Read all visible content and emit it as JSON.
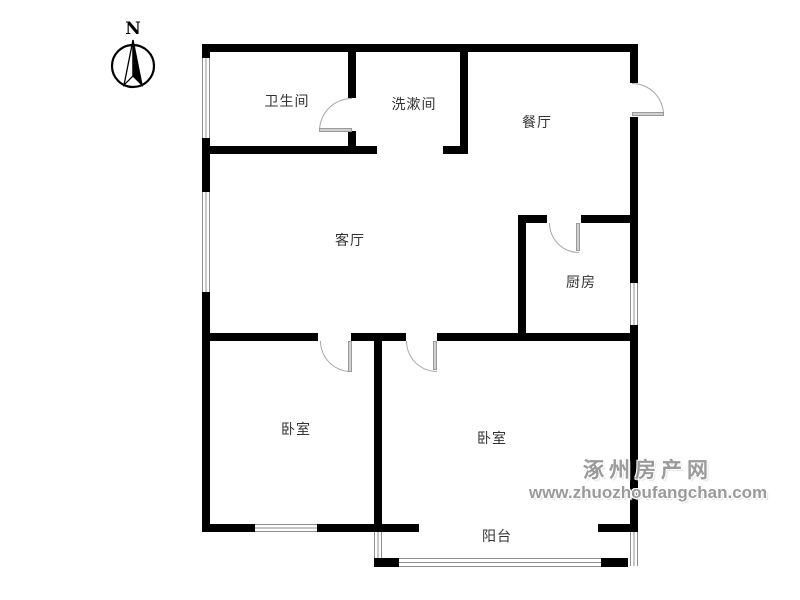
{
  "compass": {
    "label": "N"
  },
  "watermark": {
    "line1": "涿州房产网",
    "line2": "www.zhuozhoufangchan.com",
    "color": "#9a9a9a"
  },
  "rooms": [
    {
      "id": "bathroom",
      "label": "卫生间",
      "x": 287,
      "y": 101
    },
    {
      "id": "washroom",
      "label": "洗漱间",
      "x": 414,
      "y": 104
    },
    {
      "id": "dining",
      "label": "餐厅",
      "x": 537,
      "y": 122
    },
    {
      "id": "living",
      "label": "客厅",
      "x": 350,
      "y": 240
    },
    {
      "id": "kitchen",
      "label": "厨房",
      "x": 581,
      "y": 282
    },
    {
      "id": "bedroom-left",
      "label": "卧室",
      "x": 296,
      "y": 429
    },
    {
      "id": "bedroom-right",
      "label": "卧室",
      "x": 492,
      "y": 438
    },
    {
      "id": "balcony",
      "label": "阳台",
      "x": 497,
      "y": 536
    }
  ],
  "floorplan": {
    "wall_color": "#000000",
    "window_line_color": "#8f8f8f",
    "door_arc_color": "#a8a8a8",
    "label_color": "#333333",
    "walls": [
      {
        "id": "top",
        "x": 202,
        "y": 44,
        "w": 436,
        "h": 8
      },
      {
        "id": "left-a",
        "x": 202,
        "y": 44,
        "w": 8,
        "h": 14
      },
      {
        "id": "left-b",
        "x": 202,
        "y": 138,
        "w": 8,
        "h": 54
      },
      {
        "id": "left-c",
        "x": 202,
        "y": 292,
        "w": 8,
        "h": 240
      },
      {
        "id": "right-a",
        "x": 630,
        "y": 44,
        "w": 8,
        "h": 39
      },
      {
        "id": "right-b",
        "x": 630,
        "y": 117,
        "w": 8,
        "h": 166
      },
      {
        "id": "right-c",
        "x": 630,
        "y": 325,
        "w": 8,
        "h": 207
      },
      {
        "id": "bath-divider-a",
        "x": 348,
        "y": 52,
        "w": 8,
        "h": 46
      },
      {
        "id": "bath-divider-b",
        "x": 348,
        "y": 131,
        "w": 8,
        "h": 15
      },
      {
        "id": "washroom-right",
        "x": 460,
        "y": 52,
        "w": 8,
        "h": 94
      },
      {
        "id": "washroom-foot",
        "x": 443,
        "y": 146,
        "w": 25,
        "h": 8
      },
      {
        "id": "bath-bottom",
        "x": 202,
        "y": 146,
        "w": 175,
        "h": 8
      },
      {
        "id": "kitchen-top-a",
        "x": 518,
        "y": 215,
        "w": 29,
        "h": 8
      },
      {
        "id": "kitchen-top-b",
        "x": 581,
        "y": 215,
        "w": 57,
        "h": 8
      },
      {
        "id": "kitchen-left",
        "x": 518,
        "y": 223,
        "w": 8,
        "h": 110
      },
      {
        "id": "living-bottom-a",
        "x": 202,
        "y": 333,
        "w": 116,
        "h": 8
      },
      {
        "id": "living-bottom-b",
        "x": 351,
        "y": 333,
        "w": 55,
        "h": 8
      },
      {
        "id": "living-bottom-c",
        "x": 437,
        "y": 333,
        "w": 201,
        "h": 8
      },
      {
        "id": "bedroom-divider",
        "x": 374,
        "y": 341,
        "w": 8,
        "h": 183
      },
      {
        "id": "bedroom-bottom-a",
        "x": 202,
        "y": 524,
        "w": 53,
        "h": 8
      },
      {
        "id": "bedroom-bottom-b",
        "x": 317,
        "y": 524,
        "w": 102,
        "h": 8
      },
      {
        "id": "bedroom-bottom-c",
        "x": 598,
        "y": 524,
        "w": 40,
        "h": 8
      },
      {
        "id": "balcony-corner-left",
        "x": 374,
        "y": 558,
        "w": 25,
        "h": 9
      },
      {
        "id": "balcony-cap-right",
        "x": 601,
        "y": 558,
        "w": 27,
        "h": 9
      }
    ],
    "windows": [
      {
        "id": "left-upper",
        "x": 202,
        "y": 58,
        "w": 8,
        "h": 80,
        "o": "v"
      },
      {
        "id": "left-living",
        "x": 202,
        "y": 192,
        "w": 8,
        "h": 100,
        "o": "v"
      },
      {
        "id": "kitchen-right",
        "x": 630,
        "y": 283,
        "w": 8,
        "h": 42,
        "o": "v"
      },
      {
        "id": "bedroom-bottom",
        "x": 255,
        "y": 524,
        "w": 62,
        "h": 8,
        "o": "h"
      },
      {
        "id": "balcony-left",
        "x": 374,
        "y": 532,
        "w": 8,
        "h": 26,
        "o": "v"
      },
      {
        "id": "balcony-bottom",
        "x": 399,
        "y": 558,
        "w": 202,
        "h": 9,
        "o": "h"
      },
      {
        "id": "balcony-right",
        "x": 630,
        "y": 532,
        "w": 8,
        "h": 34,
        "o": "v"
      }
    ],
    "doors": [
      {
        "id": "bathroom",
        "x": 319,
        "y": 98,
        "w": 33,
        "h": 33,
        "corner": "tl"
      },
      {
        "id": "entry",
        "x": 632,
        "y": 83,
        "w": 32,
        "h": 32,
        "corner": "tr"
      },
      {
        "id": "kitchen",
        "x": 549,
        "y": 223,
        "w": 30,
        "h": 30,
        "corner": "bl"
      },
      {
        "id": "bedroom-left",
        "x": 320,
        "y": 341,
        "w": 31,
        "h": 31,
        "corner": "bl"
      },
      {
        "id": "bedroom-right",
        "x": 406,
        "y": 341,
        "w": 31,
        "h": 31,
        "corner": "bl"
      }
    ],
    "panels": [
      {
        "id": "bathroom",
        "x": 319,
        "y": 128,
        "w": 33,
        "h": 4
      },
      {
        "id": "entry",
        "x": 632,
        "y": 112,
        "w": 32,
        "h": 4
      },
      {
        "id": "kitchen",
        "x": 576,
        "y": 223,
        "w": 4,
        "h": 28
      },
      {
        "id": "bedroom-left",
        "x": 348,
        "y": 341,
        "w": 4,
        "h": 31
      },
      {
        "id": "bedroom-right",
        "x": 433,
        "y": 341,
        "w": 4,
        "h": 29
      }
    ]
  }
}
